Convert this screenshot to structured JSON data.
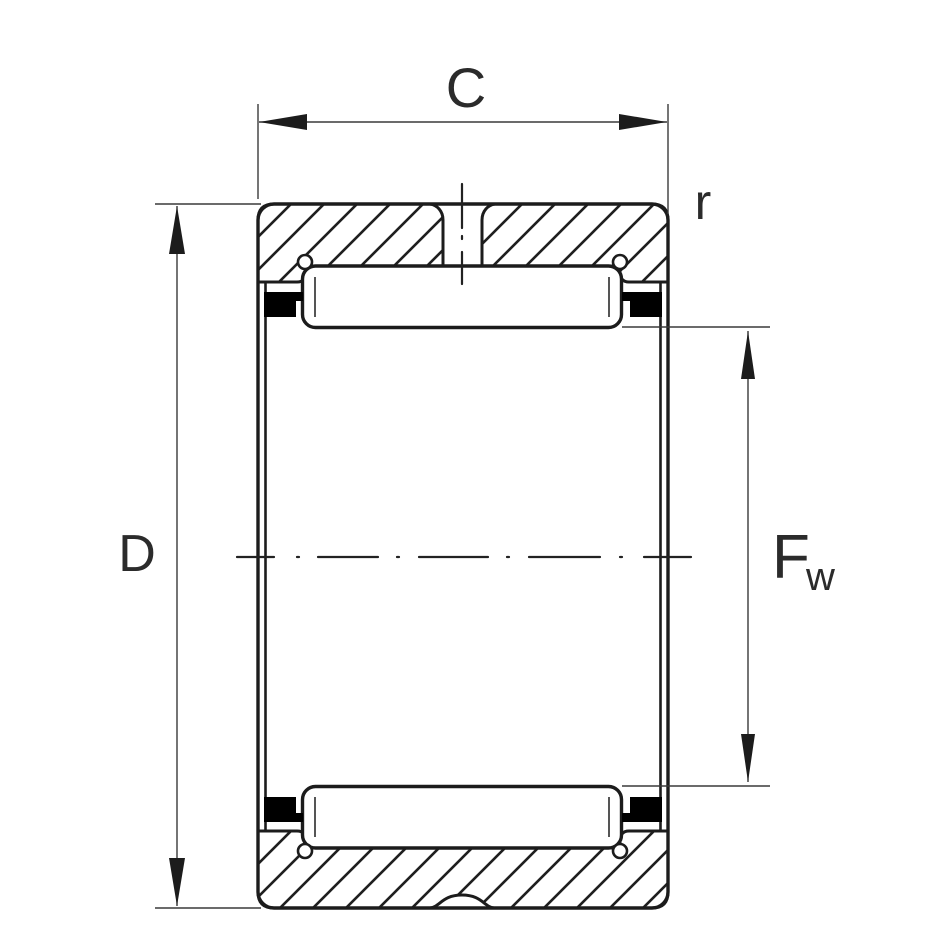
{
  "diagram": {
    "labels": {
      "width": "C",
      "outer_diameter": "D",
      "chamfer_radius": "r",
      "raceway_diameter_main": "F",
      "raceway_diameter_sub": "w"
    },
    "colors": {
      "background": "#ffffff",
      "line": "#1c1c1c",
      "dimension_line": "#3a3a3a",
      "cage_fill": "#000000",
      "text": "#2b2b2b"
    }
  }
}
